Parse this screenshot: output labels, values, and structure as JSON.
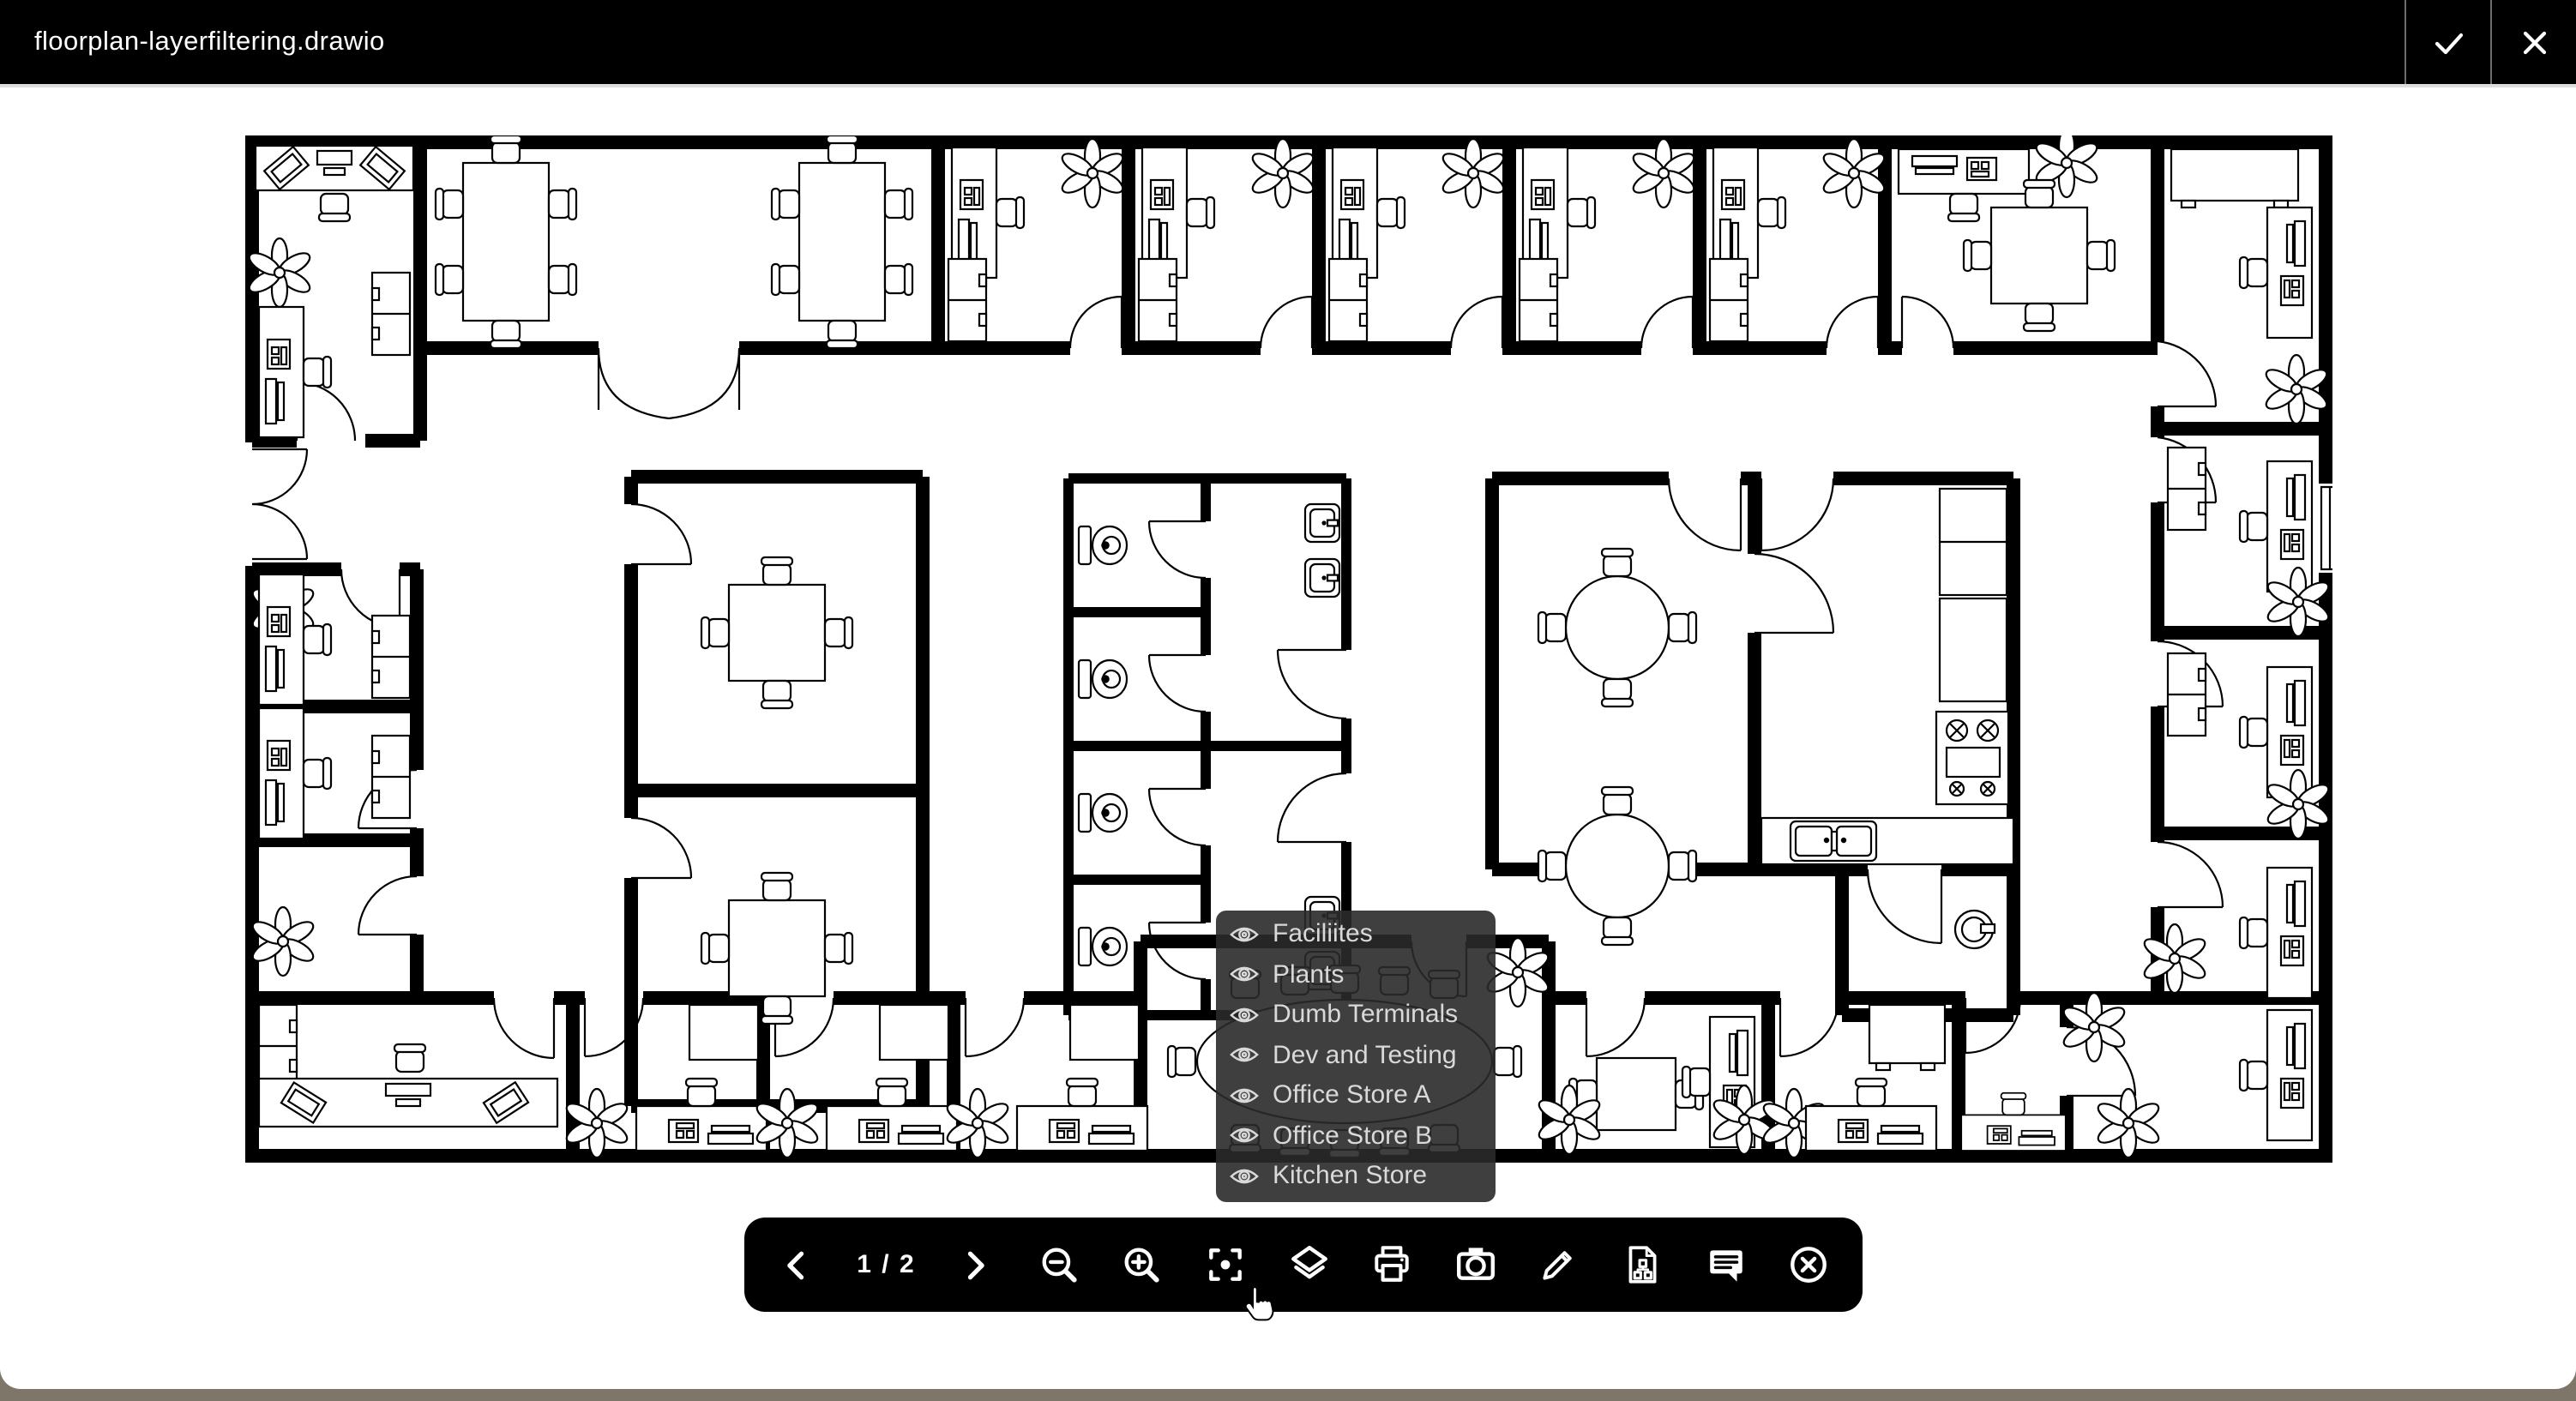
{
  "window": {
    "title": "floorplan-layerfiltering.drawio"
  },
  "titlebar": {
    "confirm_icon": "check-icon",
    "close_icon": "close-icon"
  },
  "layers_popup": {
    "visibility_icon": "eye-icon",
    "items": [
      "Faciliites",
      "Plants",
      "Dumb Terminals",
      "Dev and Testing",
      "Office Store A",
      "Office Store B",
      "Kitchen Store"
    ]
  },
  "toolbar": {
    "pager": {
      "prev_icon": "chevron-left-icon",
      "label": "1 / 2",
      "next_icon": "chevron-right-icon"
    },
    "buttons": [
      "zoom-out",
      "zoom-in",
      "fit-page",
      "layers",
      "print",
      "camera",
      "edit",
      "export-diagram",
      "comments",
      "close"
    ]
  },
  "floorplan": {
    "content": "office floor plan: perimeter offices with desks, PCs, plants and cabinets; two central meeting rooms with square tables; washroom block with four toilet stalls and sinks; dining area with two round tables; kitchen with fridge, stove, counter and sink; conference room with oval table"
  },
  "colors": {
    "titlebar_bg": "#000000",
    "toolbar_bg": "#000000",
    "popup_bg": "rgba(42,42,42,0.9)",
    "popup_text": "#d9d9d9",
    "canvas_bg": "#ffffff",
    "desktop_bg": "#7e7769",
    "line": "#000000"
  }
}
